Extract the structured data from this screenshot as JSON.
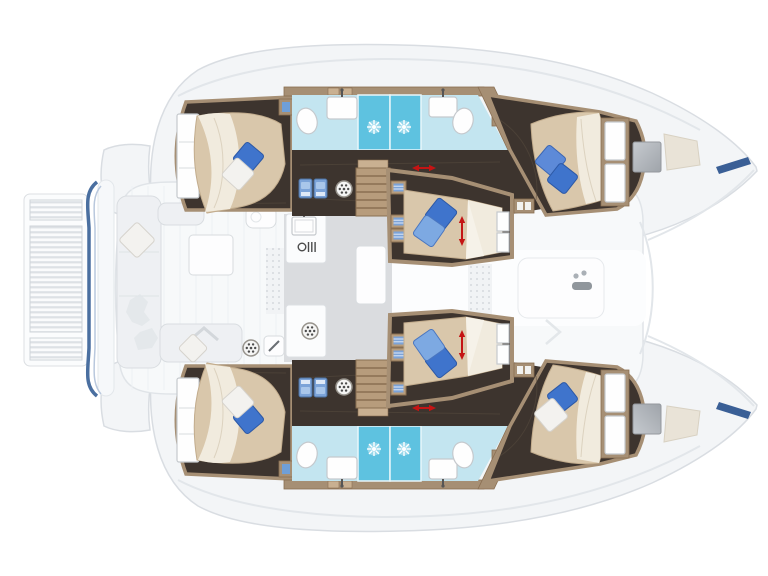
{
  "diagram": {
    "type": "boat-floor-plan",
    "subject": "Sailing catamaran interior layout plan, top-down view, bows to the right",
    "view": "top-down",
    "orientation": {
      "bow": "right",
      "stern": "left"
    },
    "hull_count": 2,
    "cabin_count": 6,
    "head_count": 4,
    "visible_text": "none"
  },
  "palette": {
    "background": "#ffffff",
    "ghost_fill": "#f3f5f7",
    "ghost_stroke": "#d9dde2",
    "deck_fill": "#f7f9fa",
    "bench_fill": "#eef0f3",
    "bench_stroke": "#d9dde1",
    "floor_dark": "#3d342e",
    "floor_grain": "#5a4d40",
    "wood_trim": "#a68f74",
    "wood_dark": "#8a6f52",
    "wood_step": "#b79c7c",
    "wood_light": "#c9b091",
    "bed": "#d9c7ab",
    "bed_edge": "#c2ac8d",
    "duvet": "#f1ebde",
    "duvet_fold": "#dcd2bf",
    "pillow_blue": "#3f74cc",
    "pillow_blue_mid": "#5d8ad8",
    "pillow_blue_light": "#7da9e2",
    "pillow_white": "#f3f2ef",
    "bath_floor": "#c3e5f0",
    "shower": "#5ec2e0",
    "fixture_stroke": "#c5c9cd",
    "locker_blue": "#7ca3d8",
    "locker_blue_dark": "#4a6fa0",
    "salon_floor": "#dadcdf",
    "counter": "#fbfcfd",
    "transom_blue": "#4a6fa0",
    "hatch_gray": "#b6babf",
    "pad_beige": "#e9e3d7",
    "arrow_red": "#c41414",
    "bow_stripe": "#3a5f96",
    "icon_ink": "#4a4a4a"
  },
  "zones": {
    "stern_platform": {
      "name": "slatted swim platform",
      "features": [
        "teak-slats",
        "blue-transom-outline"
      ]
    },
    "cockpit": {
      "name": "aft cockpit",
      "features": [
        "transom-bench",
        "diamond-seat-pillow",
        "cockpit-table",
        "aft-bench",
        "chevron-cushion",
        "wet-bar",
        "burner-dial-icon",
        "grill-icon",
        "leaf-decor"
      ]
    },
    "salon": {
      "name": "salon and galley",
      "features": [
        "galley-counter",
        "galley-sink",
        "stove-glyph",
        "island-seat",
        "settee",
        "burner-dial-icon"
      ]
    },
    "foredeck": {
      "name": "forward cockpit and foredeck",
      "features": [
        "lounge-outline",
        "windlass",
        "chevron-cushion",
        "windshield-arc"
      ]
    },
    "hulls": [
      {
        "id": "starboard-hull",
        "position": "top",
        "rooms": [
          {
            "name": "aft-cabin",
            "bed": "double-island-bed",
            "pillows": [
              "blue",
              "white"
            ],
            "furniture": [
              "wardrobe",
              "corner-locker"
            ]
          },
          {
            "name": "aft-head",
            "fixtures": [
              "toilet",
              "washbasin",
              "shower-with-jet"
            ]
          },
          {
            "name": "mid-head",
            "fixtures": [
              "toilet",
              "washbasin",
              "shower-with-jet",
              "toiletry-locker"
            ]
          },
          {
            "name": "companionway",
            "features": [
              "stairs",
              "two-blue-lockers",
              "vent-dial",
              "red-dimension-arrow"
            ]
          },
          {
            "name": "mid-cabin",
            "bed": "double-bed",
            "pillows": [
              "blue",
              "light-blue"
            ],
            "features": [
              "shelf-boxes",
              "red-dimension-arrow",
              "headboard-panels"
            ]
          },
          {
            "name": "forward-cabin",
            "bed": "double-island-bed",
            "pillows": [
              "mid-blue",
              "blue"
            ],
            "furniture": [
              "wardrobe",
              "entry-locker"
            ]
          }
        ],
        "bow_features": [
          "gray-deck-hatch",
          "beige-anchor-locker-pad",
          "navy-bow-stripe"
        ]
      },
      {
        "id": "port-hull",
        "position": "bottom",
        "mirror_of": "starboard-hull",
        "difference": {
          "forward-cabin-pillows": [
            "blue",
            "white"
          ]
        }
      }
    ]
  }
}
